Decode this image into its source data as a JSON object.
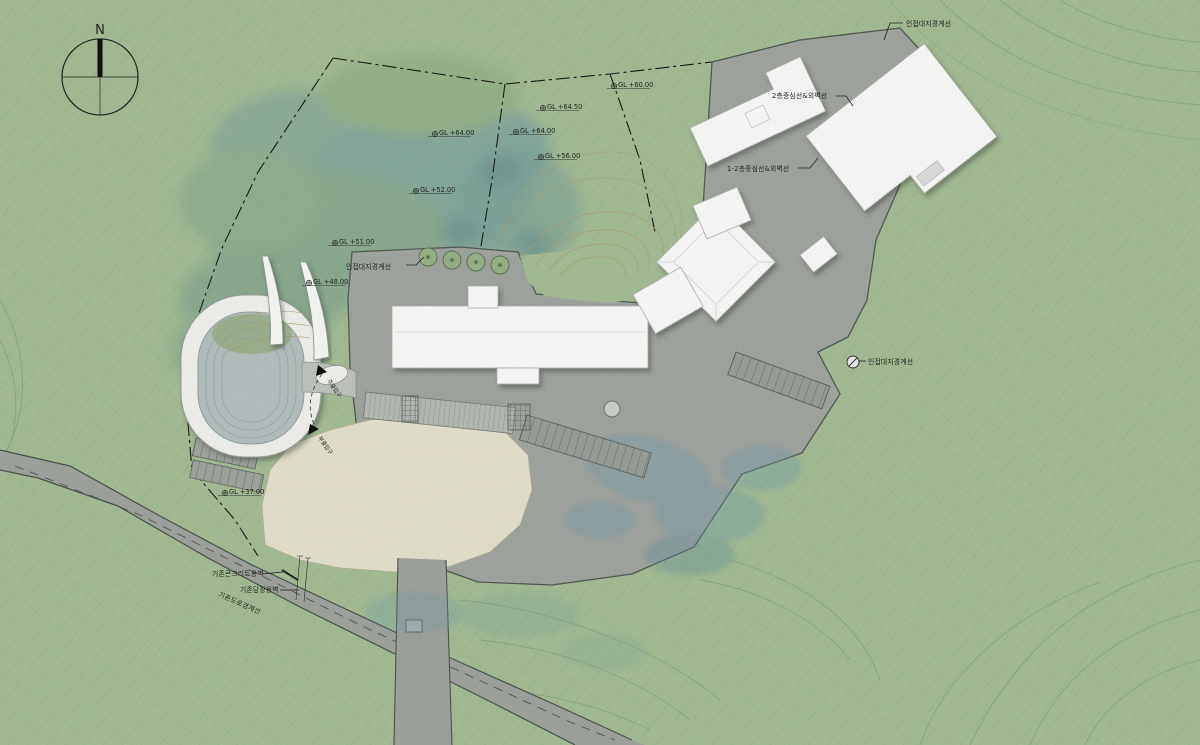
{
  "compass": {
    "north_label": "N"
  },
  "labels": {
    "boundary_topright": "인접대지경계선",
    "boundary_left": "인접대지경계선",
    "boundary_right": "인접대지경계선",
    "centerline_2f": "2층중심선&외벽선",
    "centerline_1_2f": "1-2층중심선&외벽선",
    "wall_concrete": "기존콘크리트옹벽",
    "wall_fence": "기존담장옹벽",
    "road_existing": "기존도로경계선",
    "entrance_main": "주출입구",
    "entrance_sub": "부출입구"
  },
  "elevations": [
    {
      "text": "GL +60.00"
    },
    {
      "text": "GL +64.50"
    },
    {
      "text": "GL +64.00"
    },
    {
      "text": "GL +56.00"
    },
    {
      "text": "GL +64.00"
    },
    {
      "text": "GL +52.00"
    },
    {
      "text": "GL +51.00"
    },
    {
      "text": "GL +48.00"
    },
    {
      "text": "GL +37.00"
    }
  ],
  "colors": {
    "grass": "#a8c09a",
    "plaza": "#a4a8a3",
    "sand": "#e8e4d1",
    "building": "#ffffff",
    "boundary_line": "#1c1c1c",
    "contour_tan": "#b2a176",
    "contour_green": "#7e9c70",
    "water_tint": "#6d9db0"
  }
}
